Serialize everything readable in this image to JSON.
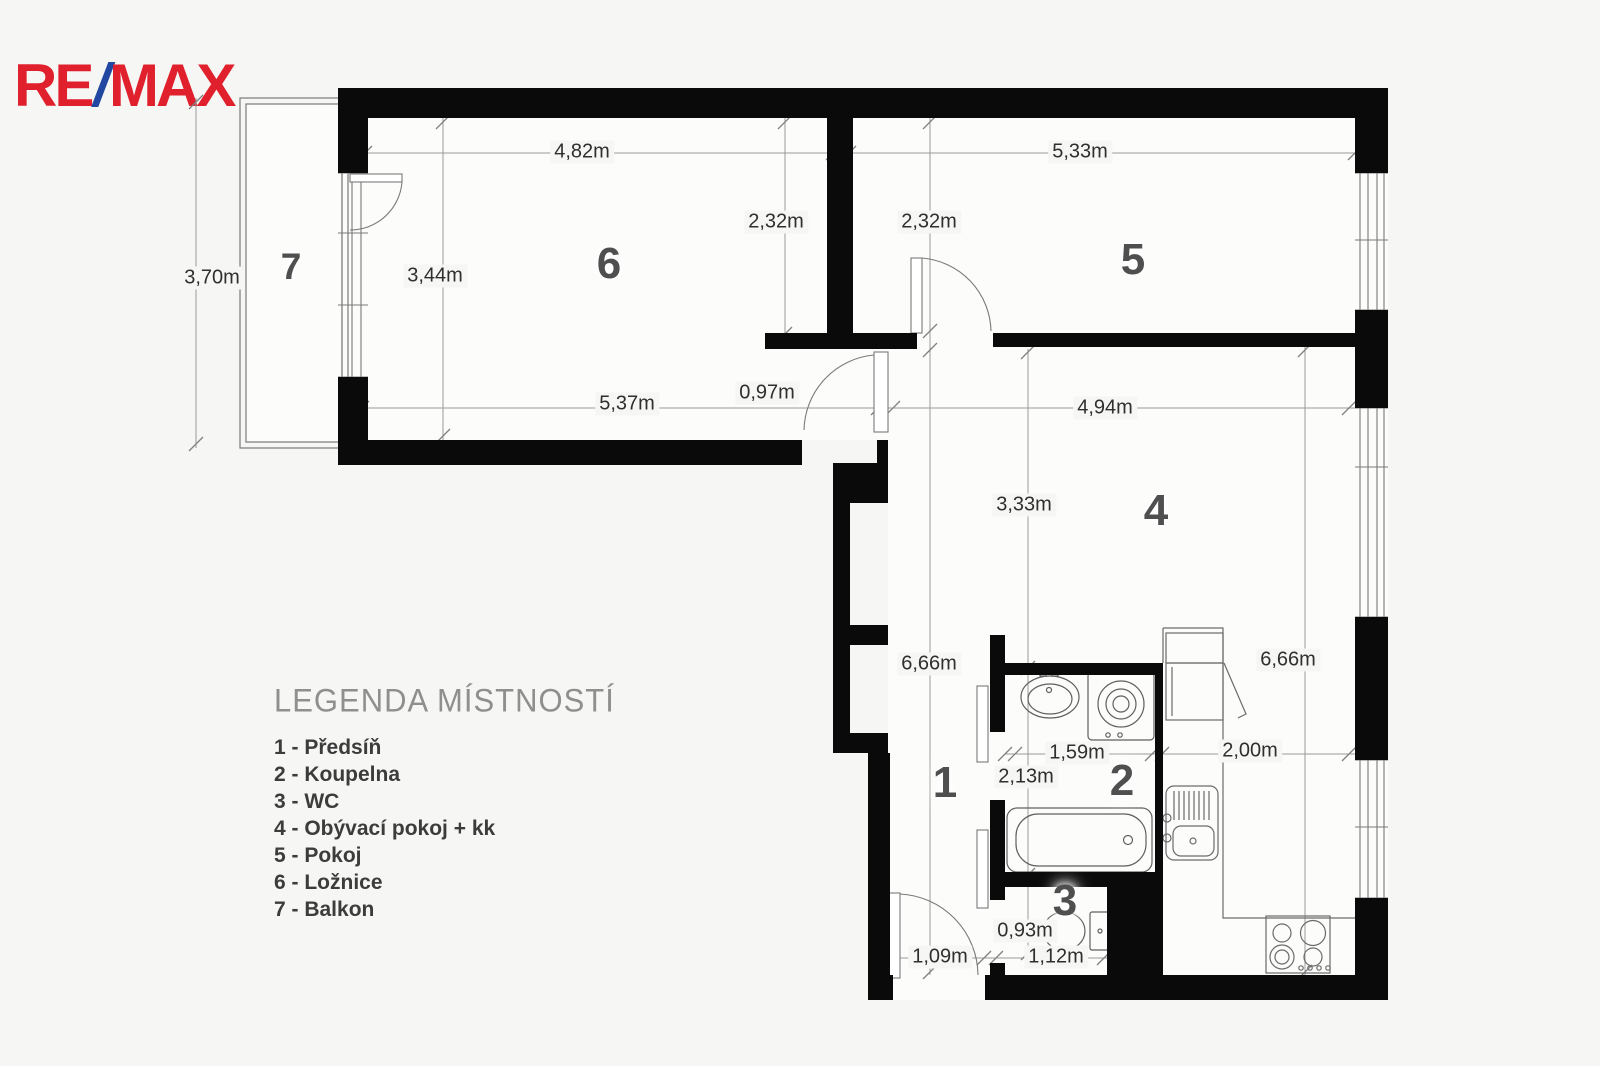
{
  "logo": {
    "part1": "RE",
    "slash": "/",
    "part2": "MAX",
    "red": "#E0202D",
    "blue": "#2247A0"
  },
  "legend": {
    "title": "LEGENDA MÍSTNOSTÍ",
    "items": [
      "1 - Předsíň",
      "2 - Koupelna",
      "3 - WC",
      "4 - Obývací pokoj + kk",
      "5 - Pokoj",
      "6 - Ložnice",
      "7 - Balkon"
    ]
  },
  "rooms": [
    {
      "number": "1",
      "name": "Předsíň",
      "x": 945,
      "y": 783,
      "size": 44
    },
    {
      "number": "2",
      "name": "Koupelna",
      "x": 1122,
      "y": 781,
      "size": 44
    },
    {
      "number": "3",
      "name": "WC",
      "x": 1065,
      "y": 901,
      "size": 44
    },
    {
      "number": "4",
      "name": "Obývací pokoj + kk",
      "x": 1156,
      "y": 511,
      "size": 44
    },
    {
      "number": "5",
      "name": "Pokoj",
      "x": 1133,
      "y": 260,
      "size": 44
    },
    {
      "number": "6",
      "name": "Ložnice",
      "x": 609,
      "y": 264,
      "size": 44
    },
    {
      "number": "7",
      "name": "Balkon",
      "x": 291,
      "y": 267,
      "size": 37
    }
  ],
  "dimensions": [
    {
      "text": "4,82m",
      "x": 582,
      "y": 152
    },
    {
      "text": "5,33m",
      "x": 1080,
      "y": 152
    },
    {
      "text": "2,32m",
      "x": 776,
      "y": 222
    },
    {
      "text": "2,32m",
      "x": 929,
      "y": 222
    },
    {
      "text": "3,70m",
      "x": 212,
      "y": 278
    },
    {
      "text": "3,44m",
      "x": 435,
      "y": 276
    },
    {
      "text": "5,37m",
      "x": 627,
      "y": 404
    },
    {
      "text": "0,97m",
      "x": 767,
      "y": 393
    },
    {
      "text": "4,94m",
      "x": 1105,
      "y": 408
    },
    {
      "text": "3,33m",
      "x": 1024,
      "y": 505
    },
    {
      "text": "6,66m",
      "x": 929,
      "y": 664
    },
    {
      "text": "6,66m",
      "x": 1288,
      "y": 660
    },
    {
      "text": "1,59m",
      "x": 1077,
      "y": 753
    },
    {
      "text": "2,13m",
      "x": 1026,
      "y": 777
    },
    {
      "text": "2,00m",
      "x": 1250,
      "y": 751
    },
    {
      "text": "0,93m",
      "x": 1025,
      "y": 931
    },
    {
      "text": "1,09m",
      "x": 940,
      "y": 957
    },
    {
      "text": "1,12m",
      "x": 1056,
      "y": 957
    }
  ],
  "colors": {
    "wall": "#0a0a0a",
    "thin_line": "#7a7a7a",
    "dim_line": "#9a9a9a",
    "background": "#f6f6f4",
    "interior": "#fcfcfb"
  }
}
